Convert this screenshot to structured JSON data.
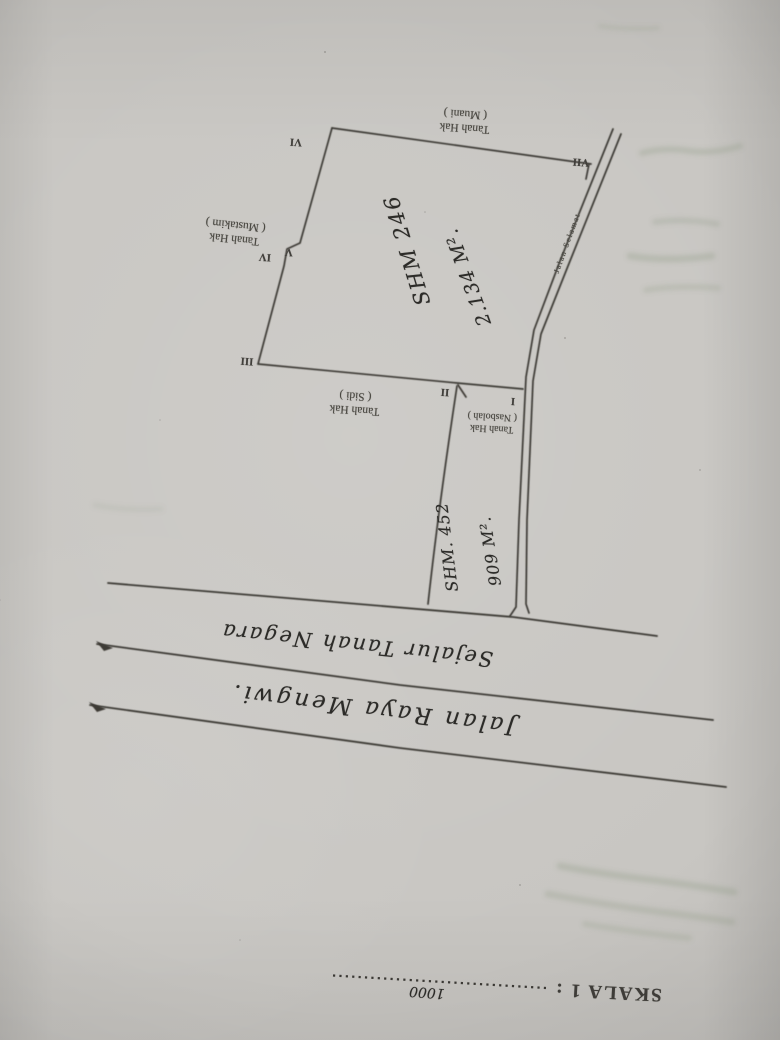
{
  "photo": {
    "scale": {
      "label": "SKALA 1 :",
      "value": "1000"
    },
    "sketch": {
      "parcel_main": {
        "shm": "SHM 246",
        "area": "2.134 M²."
      },
      "parcel_strip": {
        "shm": "SHM. 452",
        "area": "909 M²."
      },
      "neighbors": [
        {
          "name": "muani",
          "line1": "Tanah Hak",
          "line2": "( Muani )"
        },
        {
          "name": "mustakim",
          "line1": "Tanah Hak",
          "line2": "( Mustakim )"
        },
        {
          "name": "sidi",
          "line1": "Tanah Hak",
          "line2": "( Sidi )"
        },
        {
          "name": "nasbolah",
          "line1": "Tanah Hak",
          "line2": "( Nasbolah )"
        }
      ],
      "corners": {
        "i": "I",
        "ii": "II",
        "iii": "III",
        "iv": "IV",
        "v": "V",
        "vi": "VI",
        "vii": "VII"
      },
      "roads": {
        "side_road": "Jalan Selamat",
        "frontage_strip": "Sejalur Tanah Negara",
        "main_road": "Jalan Raya Mengwi."
      }
    },
    "colors": {
      "paper": "#c8c6c2",
      "ink": "#3c3a36",
      "printed_text": "#4a4842",
      "handwriting": "#2c2b28",
      "bleed_through": "#8f9a86"
    }
  }
}
